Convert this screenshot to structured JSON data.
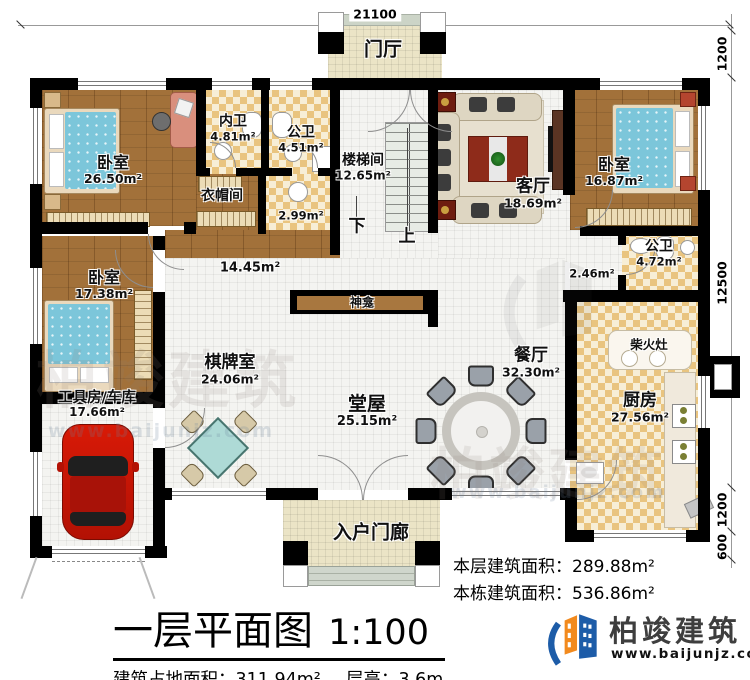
{
  "plan": {
    "rooms": [
      {
        "name": "门厅",
        "area": ""
      },
      {
        "name": "卧室",
        "area": "26.50m²"
      },
      {
        "name": "内卫",
        "area": "4.81m²"
      },
      {
        "name": "公卫",
        "area": "4.51m²"
      },
      {
        "name": "衣帽间",
        "area": "2.99m²"
      },
      {
        "name": "楼梯间",
        "area": "12.65m²"
      },
      {
        "name": "客厅",
        "area": "18.69m²"
      },
      {
        "name": "卧室",
        "area": "16.87m²"
      },
      {
        "name": "公卫",
        "area": "4.72m²"
      },
      {
        "name": "",
        "area": "2.46m²"
      },
      {
        "name": "卧室",
        "area": "17.38m²"
      },
      {
        "name": "",
        "area": "14.45m²"
      },
      {
        "name": "神龛",
        "area": ""
      },
      {
        "name": "棋牌室",
        "area": "24.06m²"
      },
      {
        "name": "堂屋",
        "area": "25.15m²"
      },
      {
        "name": "餐厅",
        "area": "32.30m²"
      },
      {
        "name": "厨房",
        "area": "27.56m²"
      },
      {
        "name": "柴火灶",
        "area": ""
      },
      {
        "name": "工具房/车库",
        "area": "17.66m²"
      },
      {
        "name": "入户门廊",
        "area": ""
      }
    ],
    "stairs": {
      "down": "下",
      "up": "上"
    },
    "dimensions": {
      "top_width": "21100",
      "right": [
        "1200",
        "12500",
        "1200",
        "600"
      ]
    }
  },
  "annotations": {
    "floor_area_label": "本层建筑面积：",
    "floor_area_value": "289.88m²",
    "building_area_label": "本栋建筑面积：",
    "building_area_value": "536.86m²"
  },
  "title_block": {
    "title": "一层平面图",
    "scale": "1:100",
    "footprint_label": "建筑占地面积：",
    "footprint_value": "311.94m²",
    "height_label": "层高：",
    "height_value": "3.6m"
  },
  "brand": {
    "name": "柏竣建筑",
    "url": "www.baijunjz.com"
  },
  "colors": {
    "wall": "#000000",
    "wood_floor": "#a2713a",
    "tile_checker": "#e9c47f",
    "logo_blue": "#1d5ca8",
    "logo_orange": "#f28a1e"
  }
}
